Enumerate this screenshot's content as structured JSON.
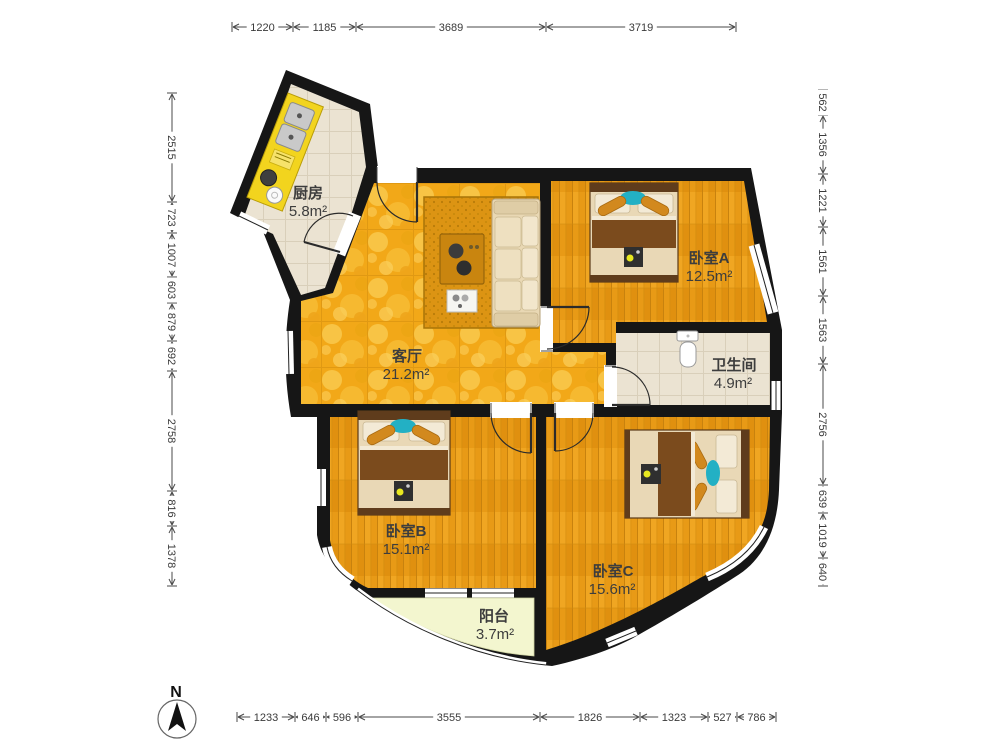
{
  "title": "apartment-floor-plan",
  "rooms": {
    "kitchen": {
      "name": "厨房",
      "area": "5.8m²"
    },
    "living": {
      "name": "客厅",
      "area": "21.2m²"
    },
    "bedroomA": {
      "name": "卧室A",
      "area": "12.5m²"
    },
    "bathroom": {
      "name": "卫生间",
      "area": "4.9m²"
    },
    "bedroomB": {
      "name": "卧室B",
      "area": "15.1m²"
    },
    "bedroomC": {
      "name": "卧室C",
      "area": "15.6m²"
    },
    "balcony": {
      "name": "阳台",
      "area": "3.7m²"
    }
  },
  "dimensions": {
    "top": [
      "1220",
      "1185",
      "3689",
      "3719"
    ],
    "bottom": [
      "1233",
      "646",
      "596",
      "3555",
      "1826",
      "1323",
      "527",
      "786"
    ],
    "left": [
      "2515",
      "723",
      "1007",
      "603",
      "879",
      "692",
      "2758",
      "816",
      "1378"
    ],
    "right": [
      "562",
      "1356",
      "1221",
      "1561",
      "1563",
      "2756",
      "639",
      "1019",
      "640"
    ]
  },
  "compass": {
    "label": "N"
  },
  "colors": {
    "wall": "#161616",
    "living_floor": "#f2a818",
    "wood_floor": "#e89a16",
    "tile_floor": "#ebe3d2",
    "balcony_floor": "#f3f6cf",
    "counter": "#f2d41e",
    "teal_pillow": "#23b0c4",
    "rug": "#dc9413",
    "blanket": "#7b4b1d"
  }
}
